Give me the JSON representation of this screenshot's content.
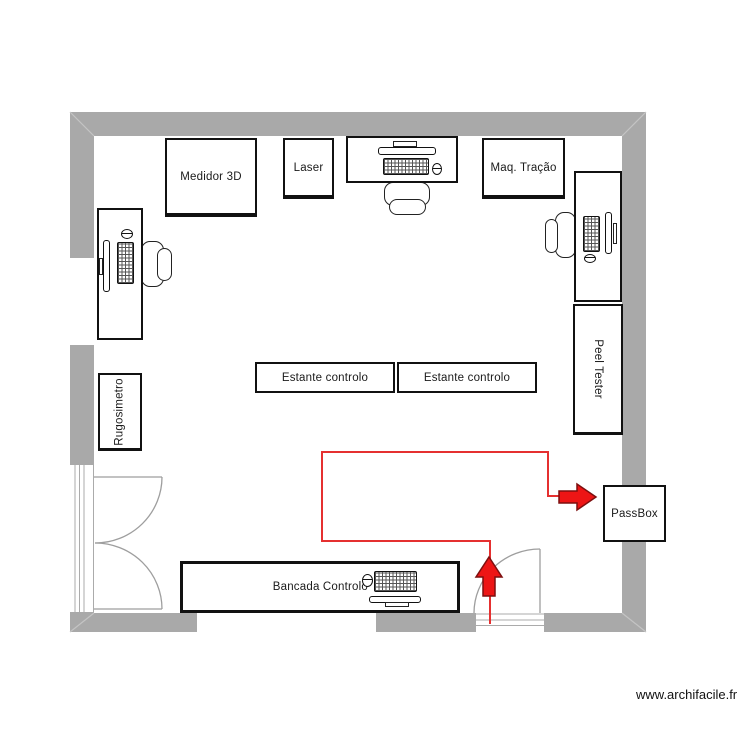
{
  "plan": {
    "watermark": "www.archifacile.fr"
  },
  "colors": {
    "wall": "#a9a9a9",
    "flow_line": "#e53030",
    "arrow_fill": "#ed1515",
    "arrow_outline": "#7d0f0f",
    "furniture_border": "#111111",
    "door_arc": "#9e9e9e"
  },
  "furniture": {
    "medidor_3d": {
      "label": "Medidor 3D"
    },
    "laser": {
      "label": "Laser"
    },
    "maq_tracao": {
      "label": "Maq. Tração"
    },
    "peel_tester": {
      "label": "Peel Tester"
    },
    "estante_controlo_1": {
      "label": "Estante controlo"
    },
    "estante_controlo_2": {
      "label": "Estante controlo"
    },
    "rugosimetro": {
      "label": "Rugosimetro"
    },
    "bancada_controlo": {
      "label": "Bancada Controlo"
    },
    "passbox": {
      "label": "PassBox"
    }
  },
  "icons": {
    "keyboard": "keyboard-icon",
    "monitor": "monitor-icon",
    "mouse": "mouse-icon",
    "chair": "office-chair-icon",
    "door": "door-swing-arc",
    "flow_arrow": "red-block-arrow"
  }
}
